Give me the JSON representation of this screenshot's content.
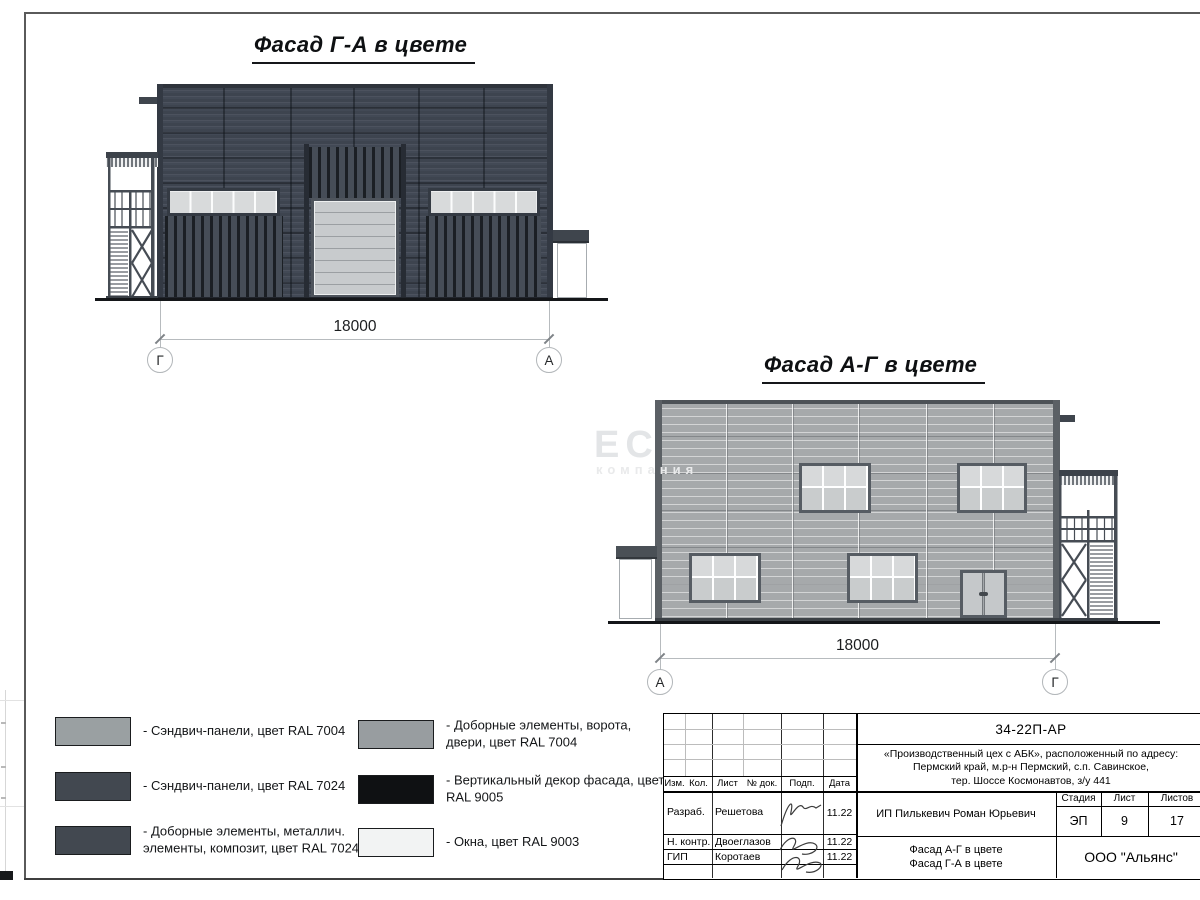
{
  "sheet": {
    "facade1": {
      "title": "Фасад Г-А в цвете",
      "dimension": "18000",
      "axis_left": "Г",
      "axis_right": "А"
    },
    "facade2": {
      "title": "Фасад А-Г в цвете",
      "dimension": "18000",
      "axis_left": "А",
      "axis_right": "Г"
    },
    "watermark": {
      "big": "ЕС",
      "small": "компания"
    }
  },
  "legend": {
    "items": [
      {
        "color": "#9aa0a2",
        "label": "- Сэндвич-панели, цвет RAL 7004"
      },
      {
        "color": "#424850",
        "label": "- Сэндвич-панели, цвет RAL 7024"
      },
      {
        "color": "#424850",
        "label": "- Доборные элементы, металлич. элементы, композит, цвет RAL 7024"
      },
      {
        "color": "#989da0",
        "label": "- Доборные элементы, ворота, двери, цвет RAL 7004"
      },
      {
        "color": "#0f1113",
        "label": "- Вертикальный декор фасада, цвет RAL 9005"
      },
      {
        "color": "#f2f3f3",
        "label": "- Окна, цвет RAL 9003"
      }
    ]
  },
  "title_block": {
    "doc_number": "34-22П-АР",
    "project_lines": [
      "«Производственный цех с АБК», расположенный по адресу:",
      "Пермский край, м.р-н Пермский, с.п. Савинское,",
      "тер. Шоссе Космонавтов, з/у 441"
    ],
    "columns": [
      "Изм.",
      "Кол.",
      "Лист",
      "№ док.",
      "Подп.",
      "Дата"
    ],
    "rows": [
      {
        "role": "Разраб.",
        "name": "Решетова",
        "date": "11.22"
      },
      {
        "role": "Н. контр.",
        "name": "Двоеглазов",
        "date": "11.22"
      },
      {
        "role": "ГИП",
        "name": "Коротаев",
        "date": "11.22"
      }
    ],
    "client": "ИП Пилькевич Роман Юрьевич",
    "stage_label": "Стадия",
    "sheet_label": "Лист",
    "sheets_label": "Листов",
    "stage": "ЭП",
    "sheet_no": "9",
    "sheets_total": "17",
    "sheet_title_lines": [
      "Фасад А-Г в цвете",
      "Фасад Г-А в цвете"
    ],
    "company": "ООО \"Альянс\""
  },
  "colors": {
    "ral7004": "#9aa0a2",
    "ral7024": "#424850",
    "ral9005": "#0f1113",
    "ral9003": "#f2f3f3",
    "facade_dark": "#424955",
    "facade_light": "#a6a9ab"
  }
}
